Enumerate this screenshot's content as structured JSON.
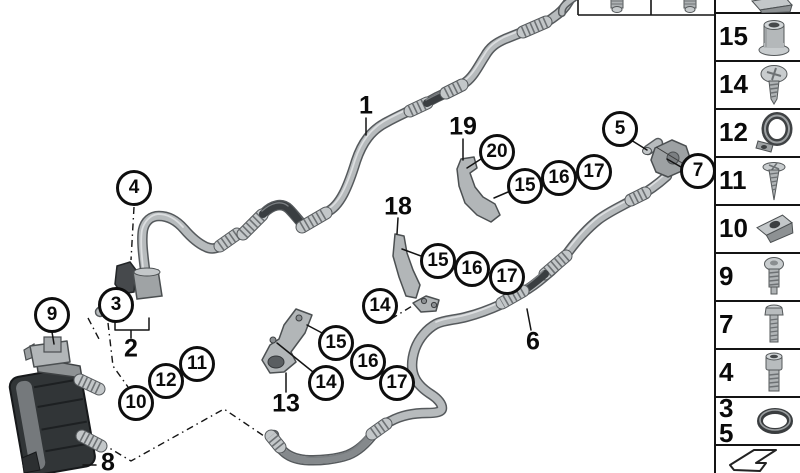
{
  "figure": {
    "kind": "parts-diagram",
    "background": "#ffffff"
  },
  "colors": {
    "line_black": "#141414",
    "pipe_outline": "#565a5d",
    "pipe_fill": "#b7bbbd",
    "pipe_highlight": "#dcdee0",
    "rubber_dark": "#3a3e41",
    "hose_mid": "#85898c",
    "coupling_fill": "#c3c7c9",
    "bracket_fill": "#b2b6b8",
    "cooler_dark": "#313537",
    "cooler_face": "#75797c"
  },
  "callouts": {
    "c4": "4",
    "c3": "3",
    "c9": "9",
    "c10": "10",
    "c12": "12",
    "c11": "11",
    "c14a": "14",
    "c15a": "15",
    "c16a": "16",
    "c17a": "17",
    "c14b": "14",
    "c15b": "15",
    "c16b": "16",
    "c17b": "17",
    "c15c": "15",
    "c16c": "16",
    "c17c": "17",
    "c20": "20",
    "c5": "5",
    "c7": "7"
  },
  "labels": {
    "l1": "1",
    "l2": "2",
    "l6": "6",
    "l8": "8",
    "l13": "13",
    "l18": "18",
    "l19": "19"
  },
  "sidebar": {
    "cells": [
      {
        "label": "",
        "icon": "clip-nut-partial-icon"
      },
      {
        "label": "15",
        "icon": "grommet-sleeve-icon"
      },
      {
        "label": "14",
        "icon": "pan-head-screw-icon"
      },
      {
        "label": "12",
        "icon": "pipe-clamp-icon"
      },
      {
        "label": "11",
        "icon": "countersunk-screw-icon"
      },
      {
        "label": "10",
        "icon": "clip-nut-icon"
      },
      {
        "label": "9",
        "icon": "round-head-bolt-icon"
      },
      {
        "label": "7",
        "icon": "hex-bolt-icon"
      },
      {
        "label": "4",
        "icon": "socket-head-bolt-icon"
      },
      {
        "label": "3",
        "label2": "5",
        "icon": "o-ring-icon"
      },
      {
        "label": "",
        "icon": "continuation-arrow-icon"
      }
    ]
  },
  "top_strip": {
    "cells": [
      {
        "icon": "screw-stud-icon"
      },
      {
        "icon": "screw-stud-icon"
      }
    ]
  }
}
